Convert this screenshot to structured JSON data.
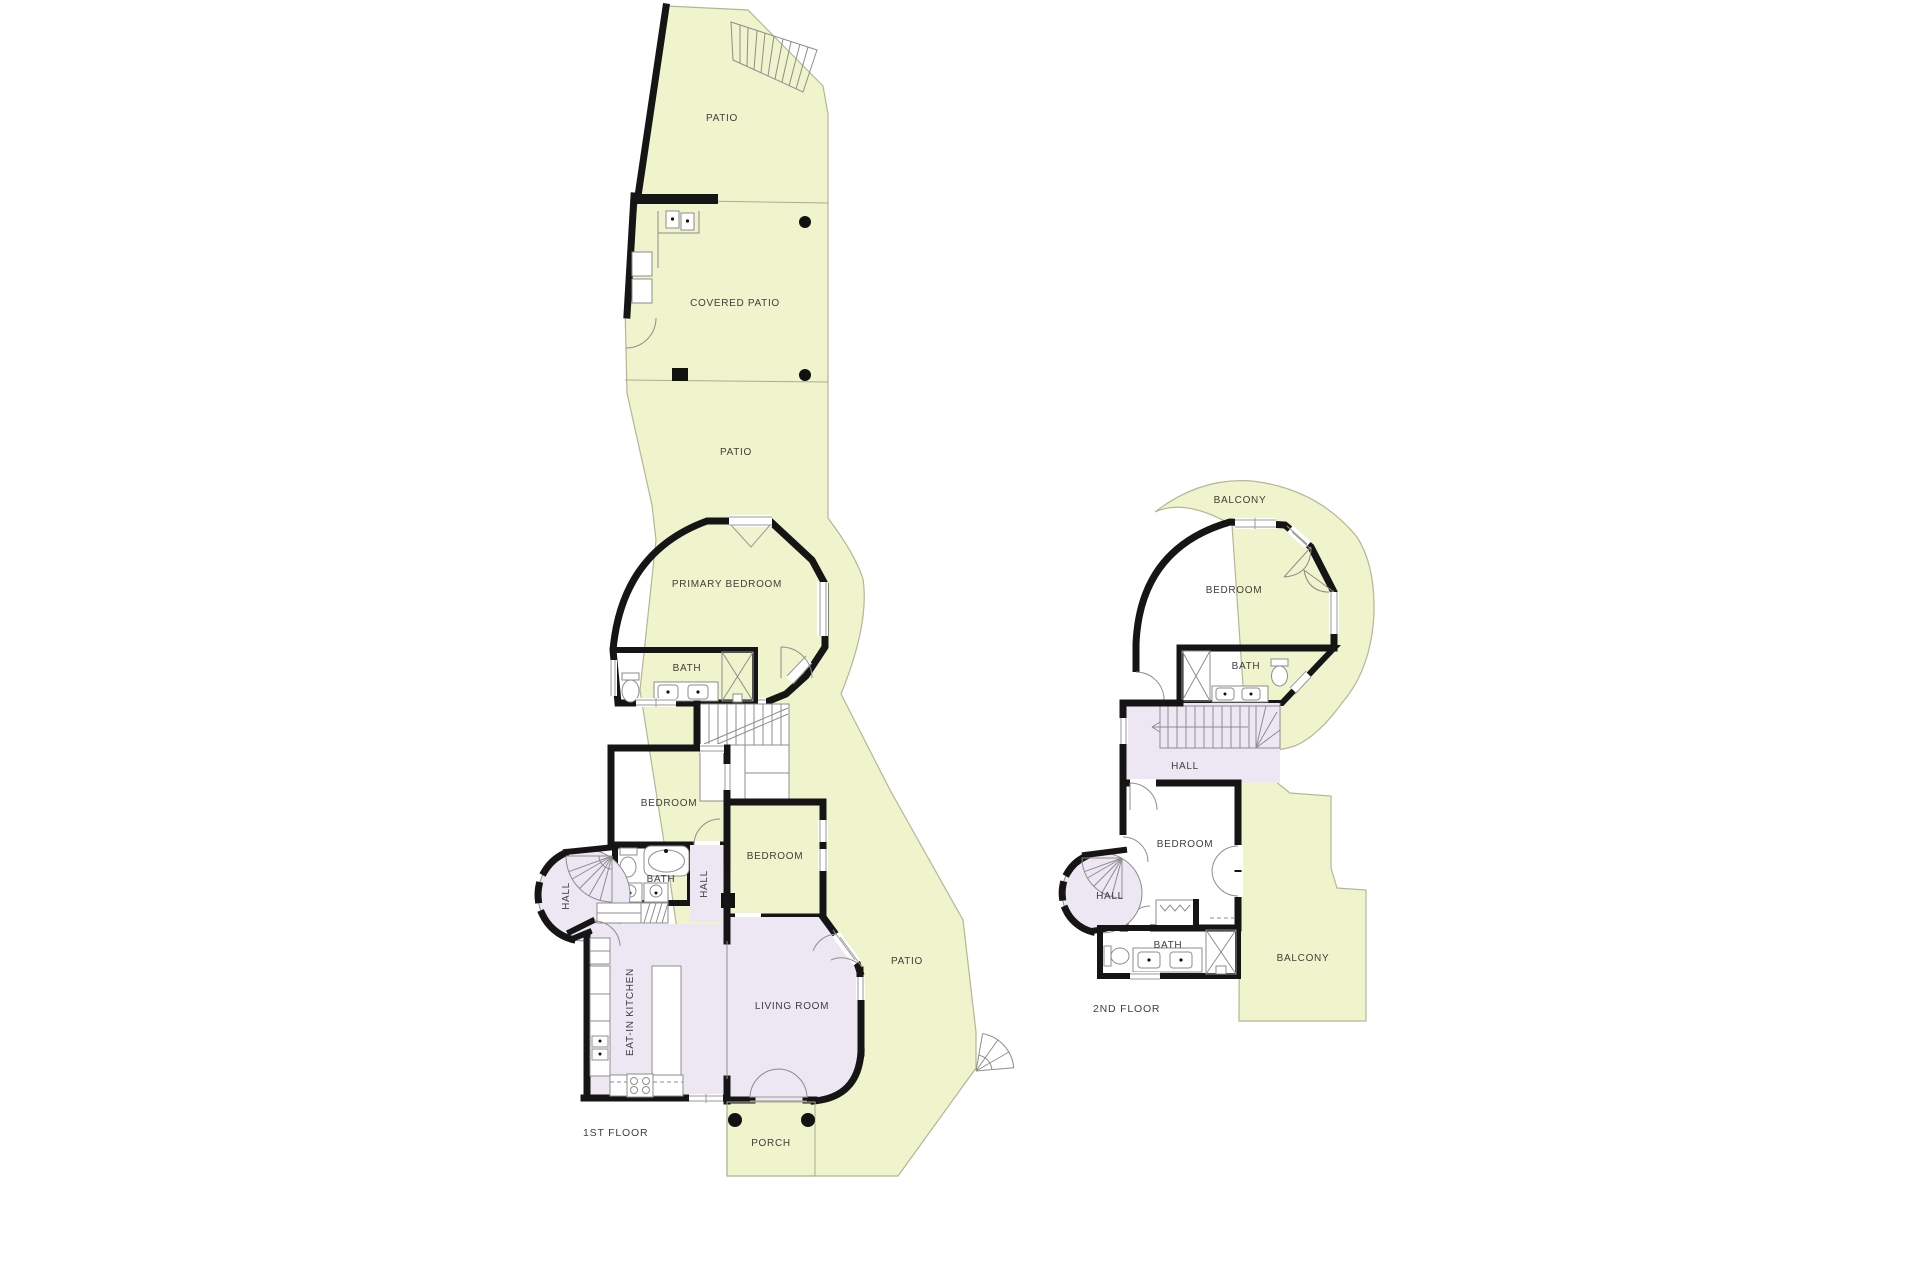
{
  "document": {
    "type": "floor-plan-drawing"
  },
  "colors": {
    "patio_fill": "#eff4cc",
    "bedroom_fill": "#ebcaa1",
    "bath_fill": "#c1e2e9",
    "living_fill": "#ede6f3",
    "wall": "#151515",
    "label_text": "#3e3e3e",
    "background": "#ffffff"
  },
  "floors": {
    "first": {
      "label": "1ST FLOOR",
      "rooms": {
        "patio_top": "PATIO",
        "covered_patio": "COVERED PATIO",
        "patio_mid": "PATIO",
        "primary_bedroom": "PRIMARY BEDROOM",
        "primary_bath": "BATH",
        "bedroom_left": "BEDROOM",
        "bedroom_right": "BEDROOM",
        "hall_corridor": "HALL",
        "hall_tower": "HALL",
        "bath_small": "BATH",
        "eat_in_kitchen": "EAT-IN KITCHEN",
        "living_room": "LIVING ROOM",
        "patio_right": "PATIO",
        "porch": "PORCH"
      }
    },
    "second": {
      "label": "2ND FLOOR",
      "rooms": {
        "balcony_top": "BALCONY",
        "bedroom_top": "BEDROOM",
        "bath_upper": "BATH",
        "hall_stairs": "HALL",
        "bedroom_lower": "BEDROOM",
        "hall_tower": "HALL",
        "bath_lower": "BATH",
        "balcony_right": "BALCONY"
      }
    }
  }
}
